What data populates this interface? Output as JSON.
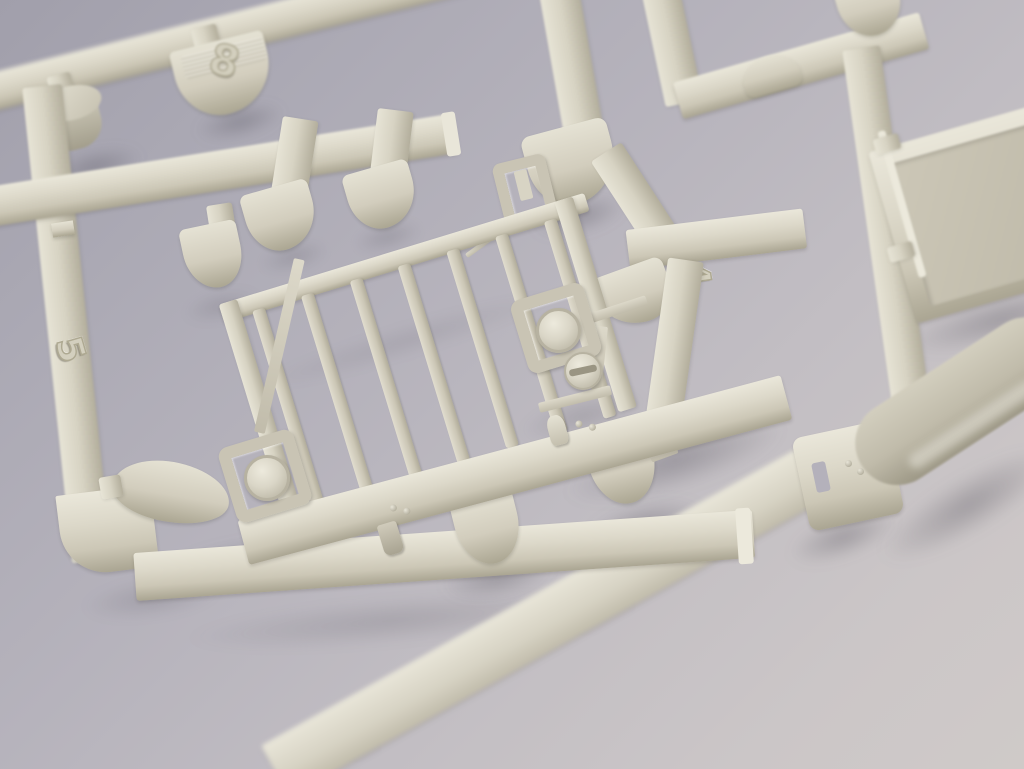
{
  "scene": {
    "type": "photograph",
    "subject": "Close-up of a light grey injection-moulded plastic model-kit sprue (parts runner) photographed at an angle on a plain grey studio backdrop",
    "depth_of_field": "sharp in the centre, soft blur at the edges",
    "colors": {
      "background_top_left": "#a19fab",
      "background_bottom_right": "#cfcac8",
      "plastic_highlight": "#eae7da",
      "plastic_base": "#d6d2c2",
      "plastic_shadow": "#aaa592",
      "tank_part": "#c0bbaa"
    }
  },
  "sprue": {
    "molded_numbers": [
      {
        "value": "8",
        "location": "tab hanging from the top-left runner"
      },
      {
        "value": "5",
        "location": "left vertical runner"
      },
      {
        "value": "4",
        "location": "centre-right runner junction"
      }
    ],
    "grille": {
      "bar_count": 7,
      "description": "rectangular grille / brush-guard part with vertical bars and wide bumper bar"
    },
    "parts": [
      "cylinder part",
      "grille guard with vertical bars",
      "bumper bar with small clips and rivets",
      "headlight box with round dome lens (left)",
      "headlight box with round dome lens (right)",
      "small slotted lens disc",
      "small bracket with inner tab",
      "flat panel part",
      "rounded tank / fender part",
      "bell-shaped sprue gates",
      "runner rails"
    ]
  }
}
